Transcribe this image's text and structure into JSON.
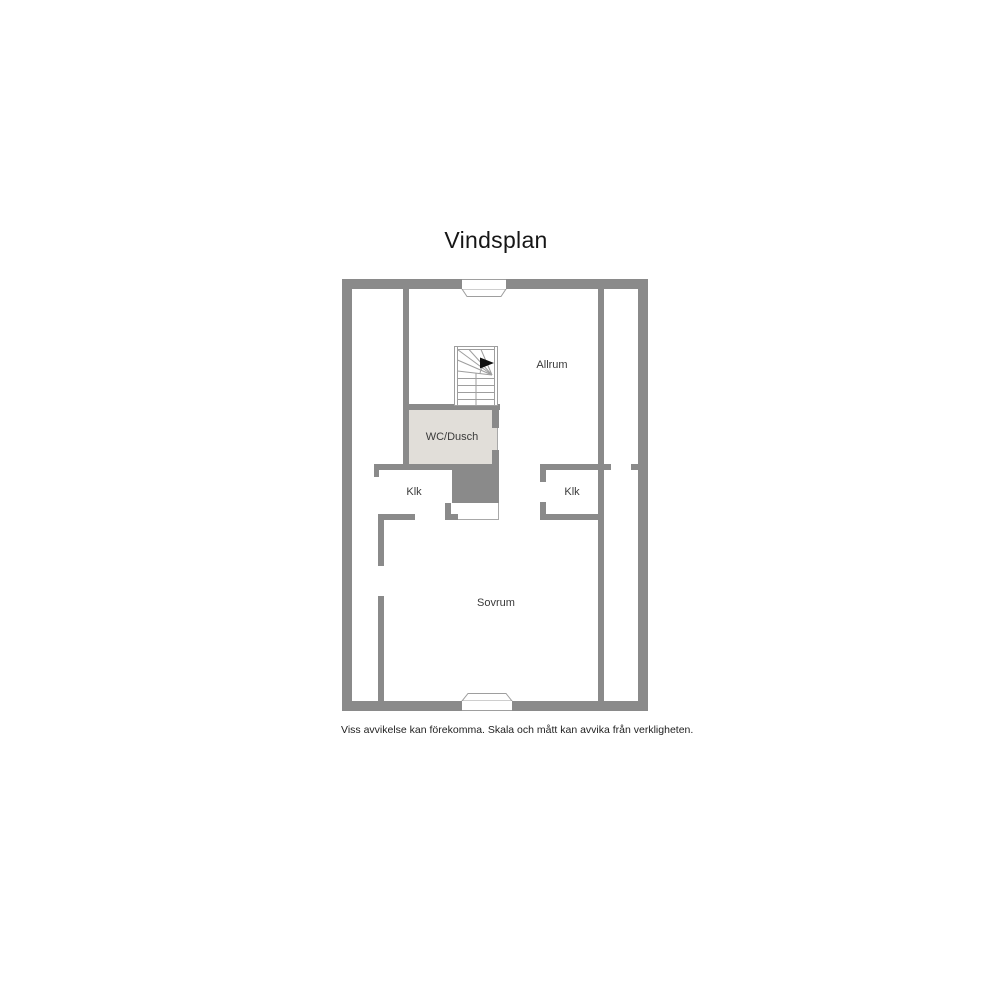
{
  "page": {
    "title": "Vindsplan",
    "disclaimer": "Viss avvikelse kan förekomma. Skala och mått kan avvika från verkligheten."
  },
  "floorplan": {
    "floor_name": "Vindsplan",
    "rooms": [
      {
        "name": "Allrum"
      },
      {
        "name": "WC/Dusch"
      },
      {
        "name": "Klk"
      },
      {
        "name": "Klk"
      },
      {
        "name": "Sovrum"
      }
    ],
    "features": [
      {
        "name": "staircase",
        "description": "winder staircase with up-direction arrow"
      },
      {
        "name": "roof-window-top-center"
      },
      {
        "name": "roof-window-bottom-center"
      }
    ],
    "colors": {
      "wall": "#8a8a8a",
      "wet_room_floor": "#e1ded9",
      "floor": "#ffffff",
      "stair_outline": "#9e9e9e",
      "label_text": "#3a3a3a",
      "title_text": "#161616"
    }
  }
}
